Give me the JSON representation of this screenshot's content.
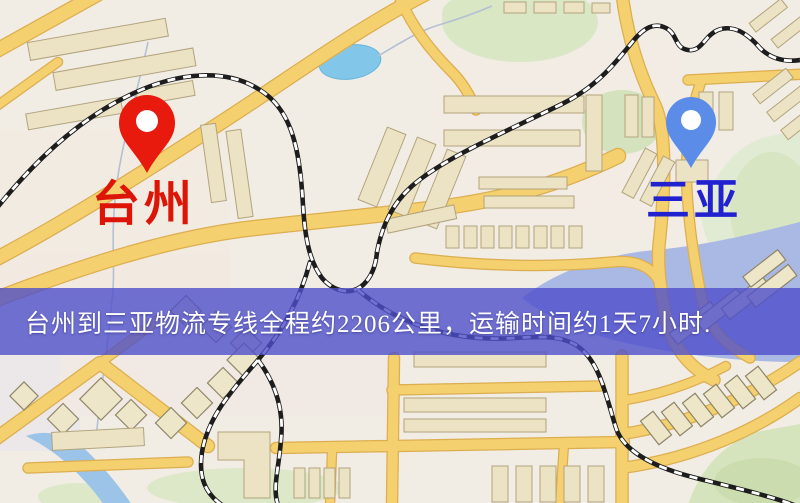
{
  "map": {
    "banner": {
      "text": "台州到三亚物流专线全程约2206公里，运输时间约1天7小时.",
      "background_color": "#4f4fcb",
      "text_color": "#ffffff"
    },
    "origin": {
      "label": "台州",
      "label_color": "#dd1507",
      "pin_color": "#e8190d",
      "pin_icon": "red-location-pin"
    },
    "destination": {
      "label": "三亚",
      "label_color": "#2121cf",
      "pin_color": "#5b8de8",
      "pin_icon": "blue-location-pin"
    },
    "route": {
      "distance_km": "2206",
      "duration": "1天7小时"
    },
    "palette": {
      "map_background": "#f1ede5",
      "road_fill": "#f5d06e",
      "road_casing": "#dcae50",
      "building_fill": "#ece3c4",
      "park_green": "#d9e7c4",
      "lake_blue": "#82c7e9",
      "river_blue": "#9cc3e8",
      "bay_blue": "#a9b9e4",
      "railway": "#1d1d1d"
    }
  }
}
